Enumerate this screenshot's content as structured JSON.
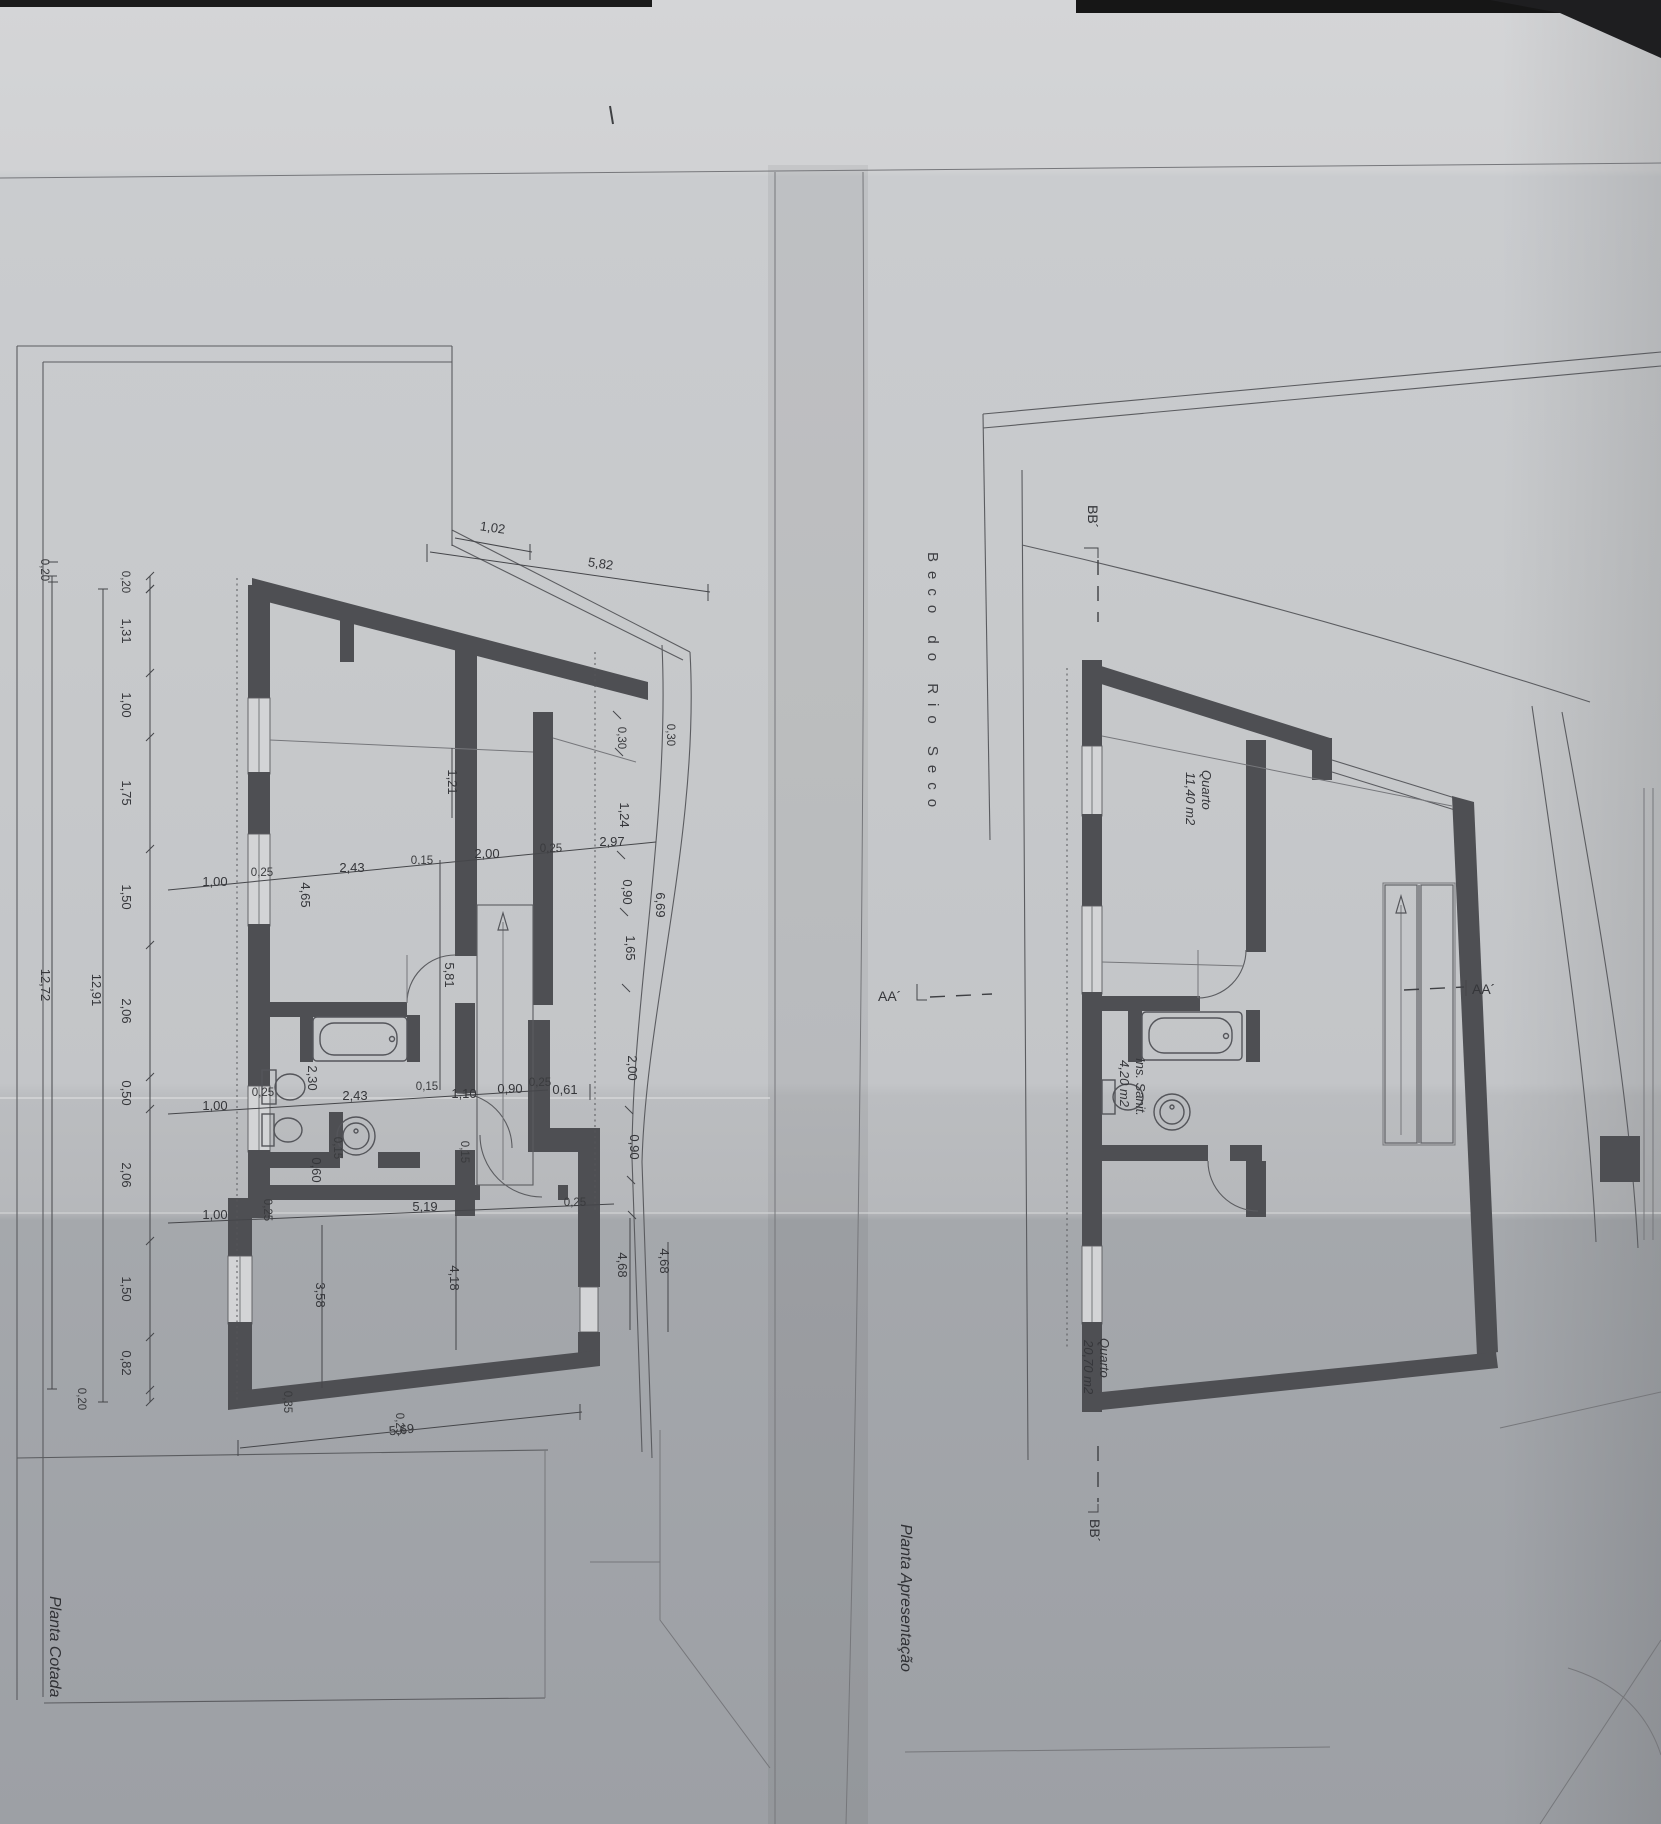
{
  "sheet": {
    "left_plan": {
      "title": "Planta Cotada",
      "dim_top_offset": "1,02",
      "dim_top_slant": "5,82",
      "chain_left": [
        "0,20",
        "1,31",
        "1,00",
        "1,75",
        "1,50",
        "2,06",
        "0,50",
        "2,06",
        "1,50",
        "0,82",
        "0,20"
      ],
      "chain_left_outer_top": "0,20",
      "total_inner": "12,91",
      "total_outer": "12,72",
      "row_upper": [
        "1,00",
        "0,25",
        "4,65",
        "2,43",
        "0,15",
        "2,00",
        "0,25",
        "2,97"
      ],
      "row_middle": [
        "1,00",
        "0,25",
        "2,30",
        "2,43",
        "0,15",
        "1,10",
        "0,90",
        "0,25",
        "0,61"
      ],
      "row_lower": [
        "1,00",
        "0,25",
        "5,19"
      ],
      "chain_right": [
        "0,30",
        "0,30",
        "1,24",
        "0,90",
        "1,65",
        "2,00",
        "0,90"
      ],
      "chain_right_total": "6,69",
      "dims_lower_right": [
        "4,68",
        "4,68"
      ],
      "dim_int_width": "1,21",
      "dim_hall": "5,81",
      "dim_wc": "2,30",
      "dim_wc_wall": "0,15",
      "dim_pass": "0,60",
      "dim_stair_side": "0,15",
      "dim_room_a": "3,58",
      "dim_room_b": "4,18",
      "dim_bottom": "5,69",
      "dim_corner_a": "0,35",
      "dim_corner_b": "0,25",
      "dim_stair_corner": "0,25"
    },
    "right_plan": {
      "title": "Planta Apresentação",
      "street": "Beco do Rio Seco",
      "rooms": [
        {
          "name": "Quarto",
          "area": "11,40 m2"
        },
        {
          "name": "Ins. Sanit.",
          "area": "4,20 m2"
        },
        {
          "name": "Quarto",
          "area": "20,70 m2"
        }
      ]
    },
    "sections": {
      "aa": "AA´",
      "bb": "BB´"
    }
  }
}
